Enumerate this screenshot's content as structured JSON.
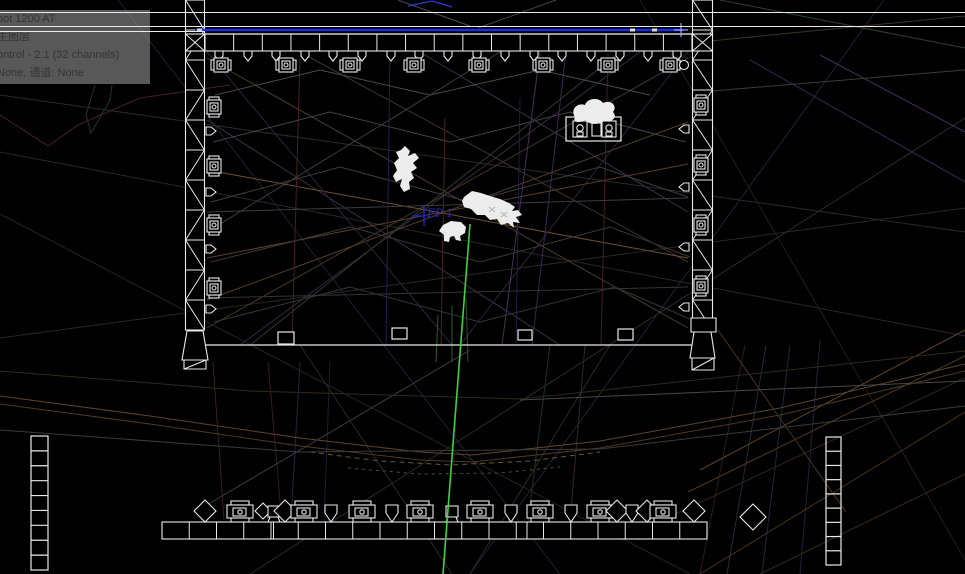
{
  "canvas": {
    "w": 965,
    "h": 574,
    "bg": "#000000"
  },
  "tooltip": {
    "lines": [
      "pot 1200 AT",
      "主图层",
      "ontrol - 2.1 (32 channels)",
      "None, 通道: None"
    ]
  },
  "ep1": {
    "label": "EP 1",
    "color": "#2525e0",
    "marker_lines": [
      [
        424,
        206,
        424,
        226
      ],
      [
        412,
        216,
        424,
        216
      ]
    ]
  },
  "colors": {
    "structure": "#e9e9e9",
    "model_fill": "#ececec",
    "pipe_blue": "#1c2ce6",
    "beam_green": "#3fd23f",
    "label_blue": "#2525e0"
  },
  "guide_lines": [
    {
      "x": 0,
      "y": 12,
      "w": 965,
      "h": 1
    },
    {
      "x": 0,
      "y": 26,
      "w": 965,
      "h": 1.4
    },
    {
      "x": 0,
      "y": 31,
      "w": 205,
      "h": 1
    }
  ],
  "scene": {
    "wire_lines": [
      [
        0,
        95,
        965,
        232,
        "#2b2b2b"
      ],
      [
        0,
        152,
        965,
        336,
        "#272727"
      ],
      [
        0,
        214,
        690,
        574,
        "#232323"
      ],
      [
        0,
        338,
        965,
        208,
        "#2e261e"
      ],
      [
        118,
        0,
        560,
        574,
        "#241c30"
      ],
      [
        884,
        0,
        470,
        574,
        "#281f34"
      ],
      [
        965,
        118,
        250,
        574,
        "#253025"
      ],
      [
        640,
        0,
        965,
        560,
        "#241f19"
      ],
      [
        207,
        58,
        688,
        328,
        "#4a3c2a"
      ],
      [
        688,
        58,
        207,
        328,
        "#443626"
      ],
      [
        207,
        120,
        560,
        345,
        "#3d2f44"
      ],
      [
        640,
        52,
        240,
        345,
        "#372840"
      ],
      [
        300,
        52,
        688,
        262,
        "#41332a"
      ],
      [
        207,
        232,
        500,
        52,
        "#3b3b3b"
      ],
      [
        420,
        52,
        688,
        212,
        "#343449"
      ],
      [
        207,
        300,
        688,
        122,
        "#55412a"
      ],
      [
        250,
        345,
        620,
        52,
        "#2d3d2d"
      ],
      [
        207,
        170,
        688,
        258,
        "#6b5136"
      ],
      [
        207,
        258,
        688,
        164,
        "#5c4026"
      ],
      [
        207,
        212,
        688,
        198,
        "#3d3d3d"
      ],
      [
        207,
        298,
        688,
        287,
        "#343434"
      ],
      [
        207,
        52,
        452,
        345,
        "#2c2338"
      ],
      [
        688,
        52,
        460,
        345,
        "#2c2338"
      ],
      [
        540,
        52,
        502,
        345,
        "#48305a"
      ],
      [
        566,
        52,
        532,
        345,
        "#3e2850"
      ],
      [
        300,
        58,
        292,
        345,
        "#482020"
      ],
      [
        445,
        118,
        441,
        345,
        "#4a2424"
      ],
      [
        608,
        54,
        601,
        345,
        "#422020"
      ],
      [
        390,
        54,
        386,
        345,
        "#20204c"
      ],
      [
        520,
        98,
        516,
        343,
        "#1f1f43"
      ],
      [
        452,
        306,
        452,
        362,
        "#2c5e2c"
      ],
      [
        466,
        298,
        468,
        362,
        "#275427"
      ],
      [
        438,
        315,
        436,
        362,
        "#2c5e2c"
      ],
      [
        213,
        362,
        224,
        520,
        "#3c1f1f"
      ],
      [
        268,
        362,
        281,
        512,
        "#381d1d"
      ],
      [
        300,
        362,
        291,
        520,
        "#2b2140"
      ],
      [
        330,
        362,
        324,
        522,
        "#241c31"
      ],
      [
        470,
        350,
        205,
        506,
        "#3e3e3e"
      ],
      [
        610,
        345,
        470,
        574,
        "#2a2a2a"
      ],
      [
        300,
        345,
        452,
        574,
        "#282828"
      ],
      [
        745,
        345,
        700,
        574,
        "#2e1d1d"
      ],
      [
        766,
        345,
        727,
        574,
        "#232c38"
      ],
      [
        790,
        345,
        762,
        574,
        "#1f2936"
      ],
      [
        820,
        340,
        800,
        574,
        "#27203a"
      ],
      [
        550,
        345,
        528,
        522,
        "#1d3326"
      ],
      [
        585,
        345,
        570,
        522,
        "#332a1c"
      ],
      [
        700,
        470,
        965,
        330,
        "#5c4227"
      ],
      [
        688,
        492,
        965,
        356,
        "#51391f"
      ],
      [
        700,
        574,
        965,
        412,
        "#483218"
      ],
      [
        760,
        574,
        965,
        474,
        "#3a2a16"
      ],
      [
        620,
        540,
        965,
        378,
        "#33261a"
      ],
      [
        718,
        330,
        846,
        512,
        "#4a3420"
      ],
      [
        520,
        400,
        965,
        381,
        "#474747"
      ],
      [
        720,
        0,
        965,
        48,
        "#2c422c"
      ],
      [
        700,
        42,
        965,
        16,
        "#3c3428"
      ],
      [
        750,
        60,
        965,
        182,
        "#3a2850"
      ],
      [
        820,
        55,
        965,
        132,
        "#452f5e"
      ],
      [
        700,
        92,
        965,
        70,
        "#334033"
      ],
      [
        398,
        0,
        470,
        26,
        "#4c4c4c"
      ],
      [
        556,
        0,
        478,
        28,
        "#454545"
      ],
      [
        408,
        6,
        432,
        1,
        "#2a3ad0",
        1.4
      ],
      [
        432,
        1,
        452,
        7,
        "#2a3ad0",
        1.4
      ]
    ],
    "wire_polylines": [
      {
        "pts": [
          [
            0,
            396
          ],
          [
            150,
            416
          ],
          [
            300,
            438
          ],
          [
            420,
            452
          ],
          [
            472,
            455
          ],
          [
            600,
            441
          ],
          [
            780,
            408
          ],
          [
            965,
            364
          ]
        ],
        "c": "#5a452c"
      },
      {
        "pts": [
          [
            0,
            404
          ],
          [
            150,
            424
          ],
          [
            300,
            446
          ],
          [
            420,
            460
          ],
          [
            472,
            462
          ],
          [
            600,
            448
          ],
          [
            780,
            415
          ],
          [
            965,
            371
          ]
        ],
        "c": "#4c3a23"
      },
      {
        "pts": [
          [
            310,
            452
          ],
          [
            380,
            461
          ],
          [
            450,
            465
          ],
          [
            530,
            461
          ],
          [
            600,
            452
          ]
        ],
        "c": "#6e5738",
        "dash": "5 4"
      },
      {
        "pts": [
          [
            348,
            468
          ],
          [
            420,
            474
          ],
          [
            500,
            473
          ],
          [
            560,
            467
          ]
        ],
        "c": "#5f4930",
        "dash": "3 4"
      },
      {
        "pts": [
          [
            0,
            430
          ],
          [
            300,
            452
          ],
          [
            600,
            449
          ],
          [
            965,
            406
          ]
        ],
        "c": "#3b3b3b"
      },
      {
        "pts": [
          [
            0,
            371
          ],
          [
            250,
            391
          ],
          [
            520,
            399
          ],
          [
            965,
            351
          ]
        ],
        "c": "#32281c"
      },
      {
        "pts": [
          [
            0,
            115
          ],
          [
            48,
            146
          ],
          [
            78,
            125
          ],
          [
            140,
            98
          ],
          [
            230,
            85
          ]
        ],
        "c": "#44221f"
      },
      {
        "pts": [
          [
            95,
            85
          ],
          [
            86,
            115
          ],
          [
            91,
            133
          ],
          [
            110,
            100
          ],
          [
            112,
            85
          ]
        ],
        "c": "#1f3a22"
      },
      {
        "pts": [
          [
            215,
            95
          ],
          [
            320,
            70
          ],
          [
            430,
            95
          ],
          [
            540,
            70
          ],
          [
            650,
            95
          ]
        ],
        "c": "#4a4a4a"
      },
      {
        "pts": [
          [
            213,
            142
          ],
          [
            330,
            112
          ],
          [
            450,
            142
          ],
          [
            570,
            112
          ],
          [
            686,
            142
          ]
        ],
        "c": "#434343"
      },
      {
        "pts": [
          [
            211,
            202
          ],
          [
            340,
            167
          ],
          [
            470,
            202
          ],
          [
            600,
            167
          ],
          [
            688,
            197
          ]
        ],
        "c": "#3e3e3e"
      },
      {
        "pts": [
          [
            211,
            262
          ],
          [
            350,
            227
          ],
          [
            480,
            262
          ],
          [
            610,
            227
          ],
          [
            690,
            257
          ]
        ],
        "c": "#393939"
      },
      {
        "pts": [
          [
            214,
            322
          ],
          [
            350,
            287
          ],
          [
            480,
            322
          ],
          [
            615,
            287
          ],
          [
            690,
            319
          ]
        ],
        "c": "#363636"
      }
    ],
    "pipe_blue": {
      "x1": 195,
      "x2": 683,
      "y": 30,
      "w": 2.4,
      "ticks": [
        197,
        630,
        652
      ],
      "cross_x": 681
    },
    "green_beam": {
      "x1": 470,
      "y1": 224,
      "x2": 443,
      "y2": 574,
      "w": 1.6
    },
    "trusses": {
      "top": {
        "x": 205,
        "y": 34,
        "w": 487,
        "h": 17,
        "step": 28.65,
        "chord_ext": [
          185,
          34,
          713,
          34
        ]
      },
      "left": {
        "x": 185.5,
        "y": 0,
        "w": 19,
        "h": 330,
        "step": 30
      },
      "right": {
        "x": 692.5,
        "y": 0,
        "w": 20,
        "h": 330,
        "step": 30
      },
      "bottom": {
        "x": 162,
        "y": 522,
        "w": 545,
        "h": 17,
        "step": 27.25,
        "extra_posts": [
          273.5,
          527
        ]
      },
      "junction_boxes": [
        [
          185.5,
          34,
          19,
          17
        ],
        [
          692.5,
          34,
          20,
          17
        ]
      ]
    },
    "bases": [
      {
        "name": "truss-base-left",
        "paths": [
          "M187,331 L203,331 L208,360 L182,360 Z",
          "M184,360 h22 v9 h-22 Z"
        ],
        "lines": [
          [
            184,
            369,
            206,
            360
          ]
        ]
      },
      {
        "name": "truss-base-right",
        "paths": [
          "M691,318 h25 v14 h-25 Z",
          "M694,332 L711,332 L715,358 L690,358 Z",
          "M692,358 h22 v12 h-22 Z"
        ],
        "lines": [
          [
            692,
            370,
            714,
            358
          ]
        ]
      }
    ],
    "floor": {
      "line": [
        190,
        345,
        713,
        345
      ],
      "rects": [
        [
          278,
          332,
          16,
          12
        ],
        [
          392,
          328,
          15,
          11
        ],
        [
          518,
          330,
          14,
          10
        ],
        [
          618,
          329,
          15,
          11
        ]
      ]
    },
    "fixtures": {
      "top_heads": {
        "y": 65,
        "xs": [
          221,
          286,
          350,
          414,
          479,
          543,
          608,
          670
        ]
      },
      "top_clamps": {
        "y": 55,
        "xs": [
          219,
          248,
          276,
          305,
          333,
          362,
          391,
          419,
          448,
          477,
          505,
          534,
          562,
          591,
          620,
          648,
          677
        ]
      },
      "left_heads": {
        "x": 214,
        "ys": [
          107,
          166,
          225,
          288
        ]
      },
      "left_clamps": {
        "x": 209,
        "ys": [
          131,
          192,
          249,
          309
        ]
      },
      "right_heads": {
        "x": 701,
        "ys": [
          105,
          165,
          225,
          286
        ]
      },
      "right_clamps": {
        "x": 686,
        "ys": [
          129,
          187,
          247,
          307
        ]
      },
      "aux_circle": {
        "x": 684,
        "y": 65,
        "r": 4.5
      },
      "bottom": {
        "y": 511,
        "items": [
          [
            "diamond",
            205
          ],
          [
            "speaker",
            240
          ],
          [
            "diamond_s",
            263
          ],
          [
            "box",
            274
          ],
          [
            "diamond",
            285
          ],
          [
            "speaker",
            304
          ],
          [
            "clamp",
            331
          ],
          [
            "speaker",
            362
          ],
          [
            "clamp",
            392
          ],
          [
            "speaker",
            420
          ],
          [
            "box",
            452
          ],
          [
            "speaker",
            480
          ],
          [
            "clamp",
            511
          ],
          [
            "speaker",
            540
          ],
          [
            "clamp",
            571
          ],
          [
            "speaker",
            600
          ],
          [
            "diamond",
            617
          ],
          [
            "clamp",
            632
          ],
          [
            "diamond",
            647
          ],
          [
            "speaker",
            663
          ],
          [
            "diamond",
            694
          ],
          [
            "diamond_b",
            753
          ]
        ]
      }
    },
    "speaker_cluster": {
      "box": [
        566,
        117,
        55,
        24
      ],
      "speakers": [
        [
          580,
          129
        ],
        [
          609,
          129
        ]
      ],
      "mid": [
        592,
        123,
        9,
        13
      ]
    },
    "ladders": [
      {
        "name": "ladder-left",
        "x": 31,
        "y": 436,
        "w": 17,
        "h": 134,
        "rungs": 9
      },
      {
        "name": "ladder-right",
        "x": 826,
        "y": 437,
        "w": 15,
        "h": 128,
        "rungs": 9
      }
    ],
    "models": [
      {
        "name": "human-figure-model",
        "d": "M405,146 L410,151 L408,156 L415,153 L419,158 L413,163 L417,168 L411,172 L414,178 L409,182 L410,189 L404,192 L400,186 L402,179 L396,182 L393,176 L397,170 L394,163 L399,158 L396,152 L401,150 Z"
      },
      {
        "name": "crocodile-model",
        "d": "M464,197 L472,191 L481,193 L490,196 L500,199 L509,203 L515,207 L512,211 L518,210 L522,215 L516,217 L520,223 L513,222 L514,228 L508,223 L501,225 L497,219 L490,220 L485,215 L477,215 L471,209 L464,207 L462,201 Z"
      },
      {
        "name": "sheep-model",
        "d": "M443,225 L451,221 L461,222 L466,227 L465,233 L460,236 L461,241 L456,240 L454,236 L450,237 L449,242 L444,241 L444,235 L439,231 Z"
      },
      {
        "name": "tree-model",
        "d": "M575,117 C570,110 577,102 585,105 C587,98 599,97 603,103 C611,99 618,106 613,112 C618,117 612,123 604,121 C599,125 589,125 585,120 C579,124 572,122 575,117 Z"
      }
    ],
    "model_details": [
      [
        489,
        207,
        495,
        212,
        "#b5b5b5"
      ],
      [
        495,
        207,
        489,
        212,
        "#b5b5b5"
      ],
      [
        501,
        212,
        507,
        217,
        "#b5b5b5"
      ],
      [
        507,
        212,
        501,
        217,
        "#b5b5b5"
      ]
    ]
  }
}
